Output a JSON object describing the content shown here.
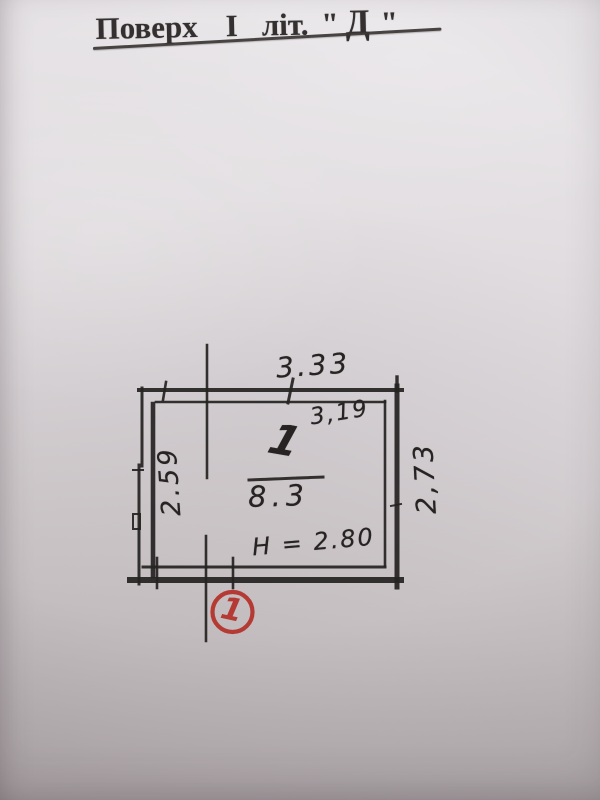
{
  "title": {
    "floor_word": "Поверх",
    "floor_number": "І",
    "lit_word": "літ.",
    "quote_open": "\"",
    "letter": "Д",
    "quote_close": "\""
  },
  "plan": {
    "dim_top_outer": "3.33",
    "dim_top_inner": "3,19",
    "dim_left": "2.59",
    "dim_right": "2,73",
    "room_number": "1",
    "room_area": "8.3",
    "height_note": "Н = 2.80",
    "marker_number": "1"
  },
  "colors": {
    "ink": "#262322",
    "marker_red": "#b43a33",
    "paper_top": "#eae7ea",
    "paper_bottom": "#b0a9ab"
  }
}
